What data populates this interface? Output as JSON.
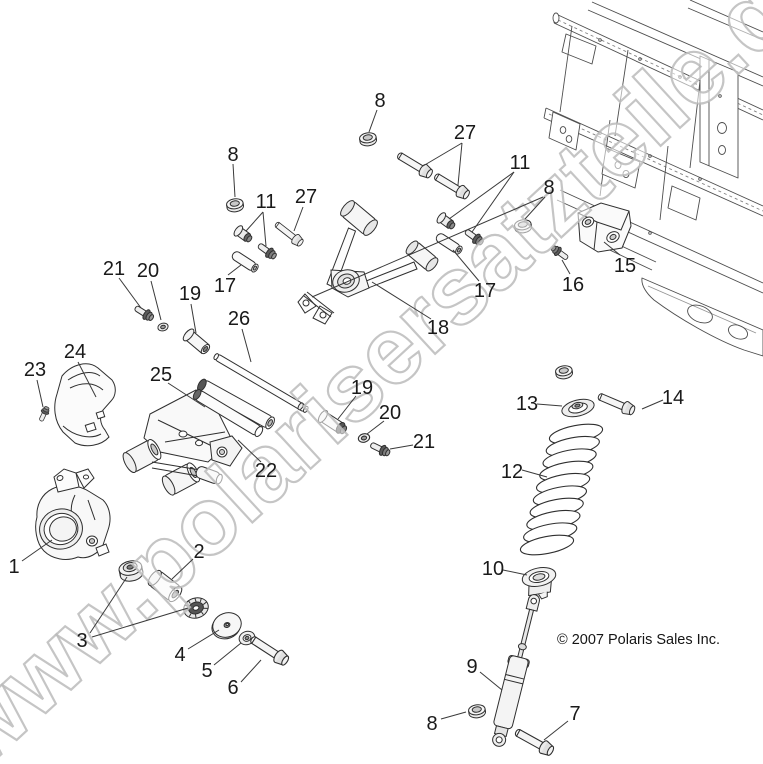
{
  "diagram": {
    "watermark": "www.polarisersatzteile.de",
    "copyright": "© 2007 Polaris Sales Inc.",
    "colors": {
      "line": "#2f2f2f",
      "leader": "#3a3a3a",
      "label": "#1a1a1a",
      "watermark_stroke": "#bbbbbb",
      "background": "#ffffff"
    },
    "callouts": [
      {
        "label": "8",
        "x": 380,
        "y": 100,
        "leaders": [
          [
            377,
            110,
            369,
            132
          ]
        ]
      },
      {
        "label": "8",
        "x": 233,
        "y": 154,
        "leaders": [
          [
            233,
            164,
            235,
            197
          ]
        ]
      },
      {
        "label": "11",
        "x": 266,
        "y": 201,
        "leaders": [
          [
            263,
            212,
            246,
            231
          ],
          [
            263,
            212,
            266,
            246
          ]
        ]
      },
      {
        "label": "27",
        "x": 306,
        "y": 196,
        "leaders": [
          [
            303,
            207,
            294,
            231
          ]
        ]
      },
      {
        "label": "27",
        "x": 465,
        "y": 132,
        "leaders": [
          [
            462,
            143,
            423,
            166
          ],
          [
            462,
            143,
            458,
            185
          ]
        ]
      },
      {
        "label": "11",
        "x": 520,
        "y": 162,
        "leaders": [
          [
            514,
            172,
            449,
            219
          ],
          [
            514,
            172,
            472,
            232
          ]
        ]
      },
      {
        "label": "8",
        "x": 549,
        "y": 187,
        "leaders": [
          [
            545,
            197,
            525,
            219
          ],
          [
            543,
            197,
            312,
            297
          ]
        ]
      },
      {
        "label": "15",
        "x": 625,
        "y": 265,
        "leaders": [
          [
            620,
            255,
            604,
            242
          ]
        ]
      },
      {
        "label": "16",
        "x": 573,
        "y": 284,
        "leaders": [
          [
            570,
            274,
            562,
            260
          ]
        ]
      },
      {
        "label": "17",
        "x": 485,
        "y": 290,
        "leaders": [
          [
            479,
            281,
            453,
            250
          ]
        ]
      },
      {
        "label": "18",
        "x": 438,
        "y": 327,
        "leaders": [
          [
            431,
            319,
            372,
            282
          ]
        ]
      },
      {
        "label": "17",
        "x": 225,
        "y": 285,
        "leaders": [
          [
            228,
            275,
            241,
            265
          ]
        ]
      },
      {
        "label": "19",
        "x": 190,
        "y": 293,
        "leaders": [
          [
            191,
            304,
            196,
            333
          ]
        ]
      },
      {
        "label": "21",
        "x": 114,
        "y": 268,
        "leaders": [
          [
            119,
            278,
            141,
            308
          ]
        ]
      },
      {
        "label": "20",
        "x": 148,
        "y": 270,
        "leaders": [
          [
            151,
            281,
            161,
            320
          ]
        ]
      },
      {
        "label": "26",
        "x": 239,
        "y": 318,
        "leaders": [
          [
            242,
            329,
            251,
            362
          ]
        ]
      },
      {
        "label": "24",
        "x": 75,
        "y": 351,
        "leaders": [
          [
            78,
            362,
            96,
            397
          ]
        ]
      },
      {
        "label": "23",
        "x": 35,
        "y": 369,
        "leaders": [
          [
            37,
            380,
            43,
            407
          ]
        ]
      },
      {
        "label": "25",
        "x": 161,
        "y": 374,
        "leaders": [
          [
            168,
            383,
            205,
            407
          ]
        ]
      },
      {
        "label": "19",
        "x": 362,
        "y": 387,
        "leaders": [
          [
            356,
            396,
            338,
            419
          ]
        ]
      },
      {
        "label": "20",
        "x": 390,
        "y": 412,
        "leaders": [
          [
            384,
            421,
            367,
            434
          ]
        ]
      },
      {
        "label": "21",
        "x": 424,
        "y": 441,
        "leaders": [
          [
            413,
            445,
            390,
            449
          ]
        ]
      },
      {
        "label": "22",
        "x": 266,
        "y": 470,
        "leaders": [
          [
            261,
            462,
            238,
            440
          ]
        ]
      },
      {
        "label": "1",
        "x": 14,
        "y": 566,
        "leaders": [
          [
            22,
            561,
            52,
            540
          ]
        ]
      },
      {
        "label": "2",
        "x": 199,
        "y": 551,
        "leaders": [
          [
            193,
            559,
            172,
            579
          ]
        ]
      },
      {
        "label": "3",
        "x": 82,
        "y": 640,
        "leaders": [
          [
            90,
            633,
            127,
            577
          ],
          [
            92,
            637,
            188,
            608
          ]
        ]
      },
      {
        "label": "4",
        "x": 180,
        "y": 654,
        "leaders": [
          [
            188,
            649,
            219,
            630
          ]
        ]
      },
      {
        "label": "5",
        "x": 207,
        "y": 670,
        "leaders": [
          [
            214,
            665,
            241,
            643
          ]
        ]
      },
      {
        "label": "6",
        "x": 233,
        "y": 687,
        "leaders": [
          [
            241,
            682,
            261,
            660
          ]
        ]
      },
      {
        "label": "13",
        "x": 527,
        "y": 403,
        "leaders": [
          [
            537,
            404,
            562,
            406
          ]
        ]
      },
      {
        "label": "14",
        "x": 673,
        "y": 397,
        "leaders": [
          [
            663,
            400,
            642,
            409
          ]
        ]
      },
      {
        "label": "12",
        "x": 512,
        "y": 471,
        "leaders": [
          [
            522,
            470,
            547,
            477
          ]
        ]
      },
      {
        "label": "10",
        "x": 493,
        "y": 568,
        "leaders": [
          [
            503,
            570,
            527,
            575
          ]
        ]
      },
      {
        "label": "9",
        "x": 472,
        "y": 666,
        "leaders": [
          [
            480,
            672,
            502,
            690
          ]
        ]
      },
      {
        "label": "8",
        "x": 432,
        "y": 723,
        "leaders": [
          [
            441,
            719,
            466,
            712
          ]
        ]
      },
      {
        "label": "7",
        "x": 575,
        "y": 713,
        "leaders": [
          [
            568,
            721,
            544,
            740
          ]
        ]
      }
    ]
  }
}
